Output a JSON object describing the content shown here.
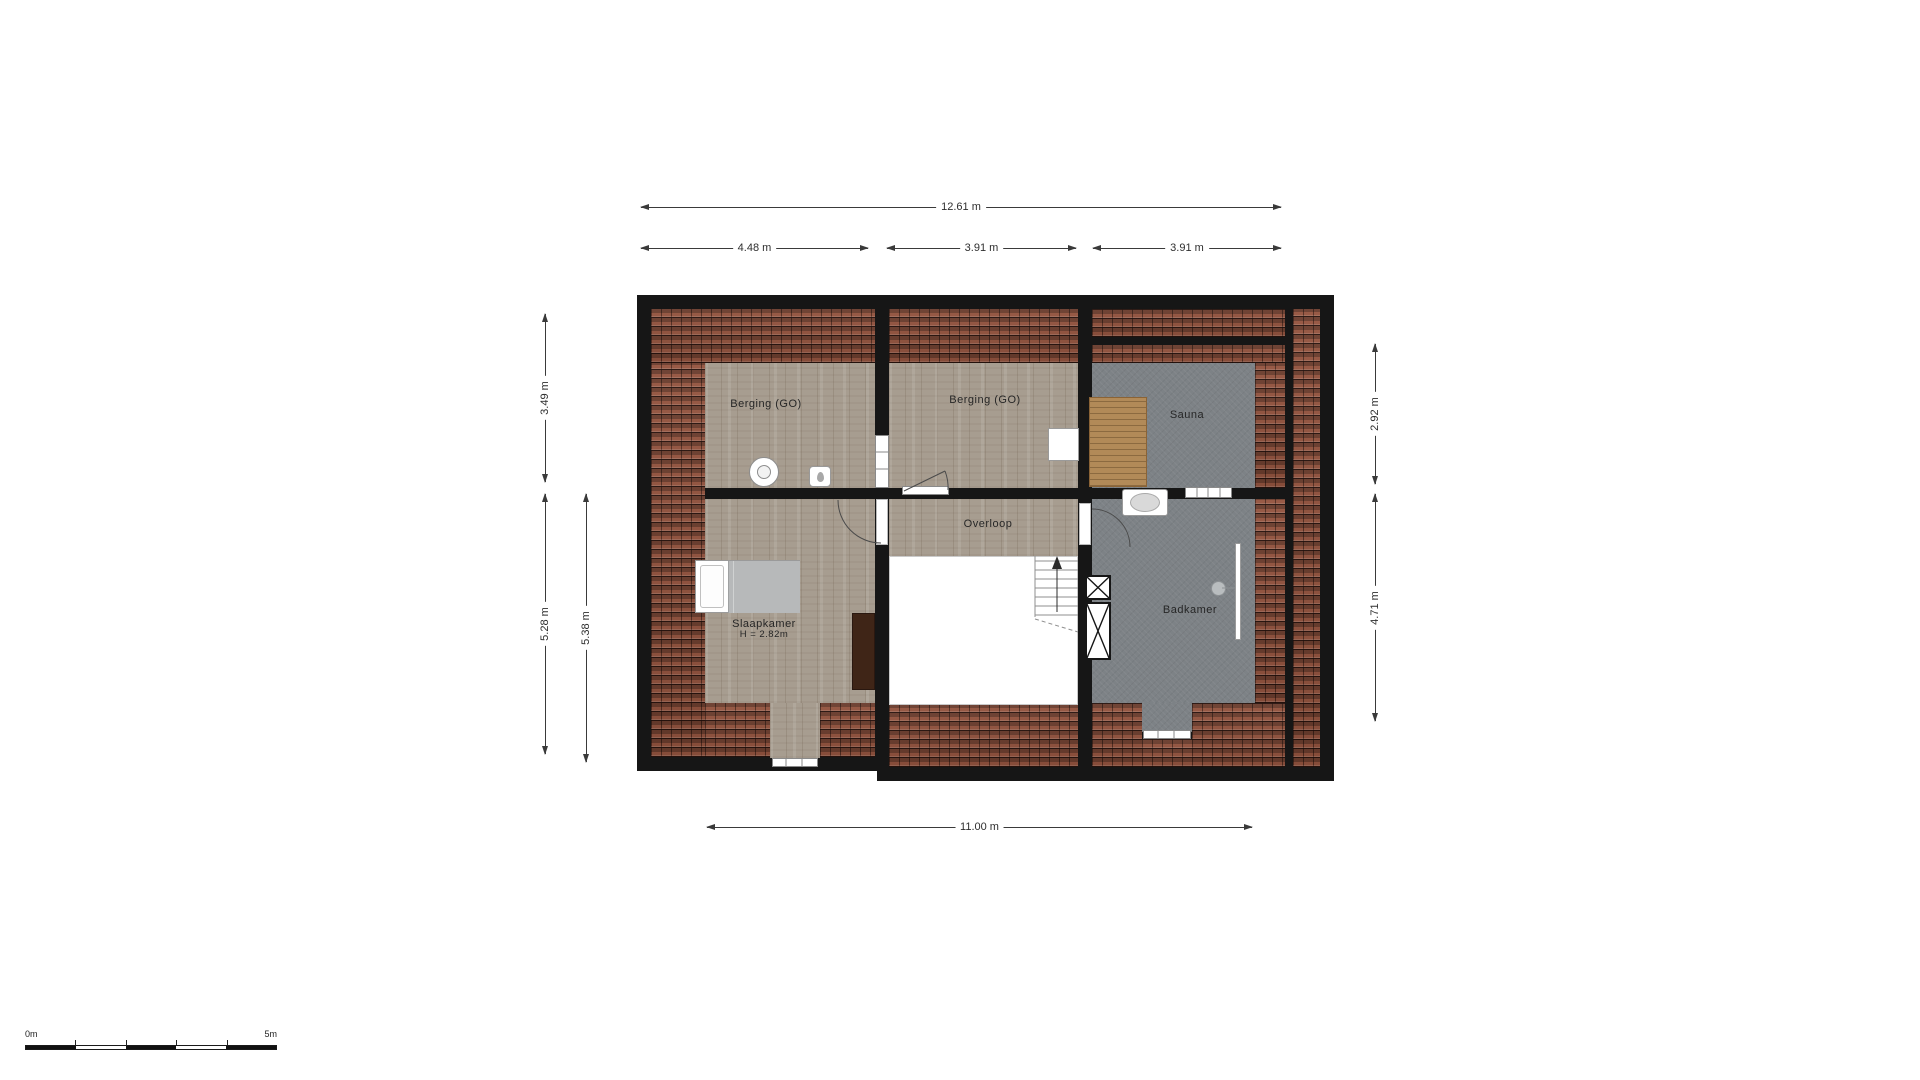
{
  "plan": {
    "rooms": {
      "berging1": "Berging (GO)",
      "berging2": "Berging (GO)",
      "sauna": "Sauna",
      "overloop": "Overloop",
      "slaapkamer": "Slaapkamer",
      "slaapkamer_height": "H = 2.82m",
      "badkamer": "Badkamer"
    },
    "fixture_icons": {
      "washing_machine": "washing-machine-icon",
      "boiler": "boiler-icon",
      "bed": "bed-icon",
      "wardrobe": "wardrobe-icon",
      "dresser": "dresser-icon",
      "sauna_bench": "sauna-bench-icon",
      "washbasin": "washbasin-icon",
      "shower": "shower-icon",
      "shafts": "shaft-icon",
      "stairs_up": "stairs-up-icon"
    },
    "colors": {
      "wall": "#161616",
      "roof_tiles": "#94543f",
      "wood_floor": "#a79d90",
      "concrete_floor": "#7d8286",
      "bench_wood": "#b28a58",
      "dimension_lines": "#3a3a3a"
    }
  },
  "dimensions": {
    "top_total": "12.61 m",
    "top_segments": [
      "4.48 m",
      "3.91 m",
      "3.91 m"
    ],
    "left_upper": "3.49 m",
    "left_lower": "5.28 m",
    "left_lower_inner": "5.38 m",
    "right_upper": "2.92 m",
    "right_lower": "4.71 m",
    "bottom_total": "11.00 m"
  },
  "scale_bar": {
    "start": "0m",
    "end": "5m"
  }
}
